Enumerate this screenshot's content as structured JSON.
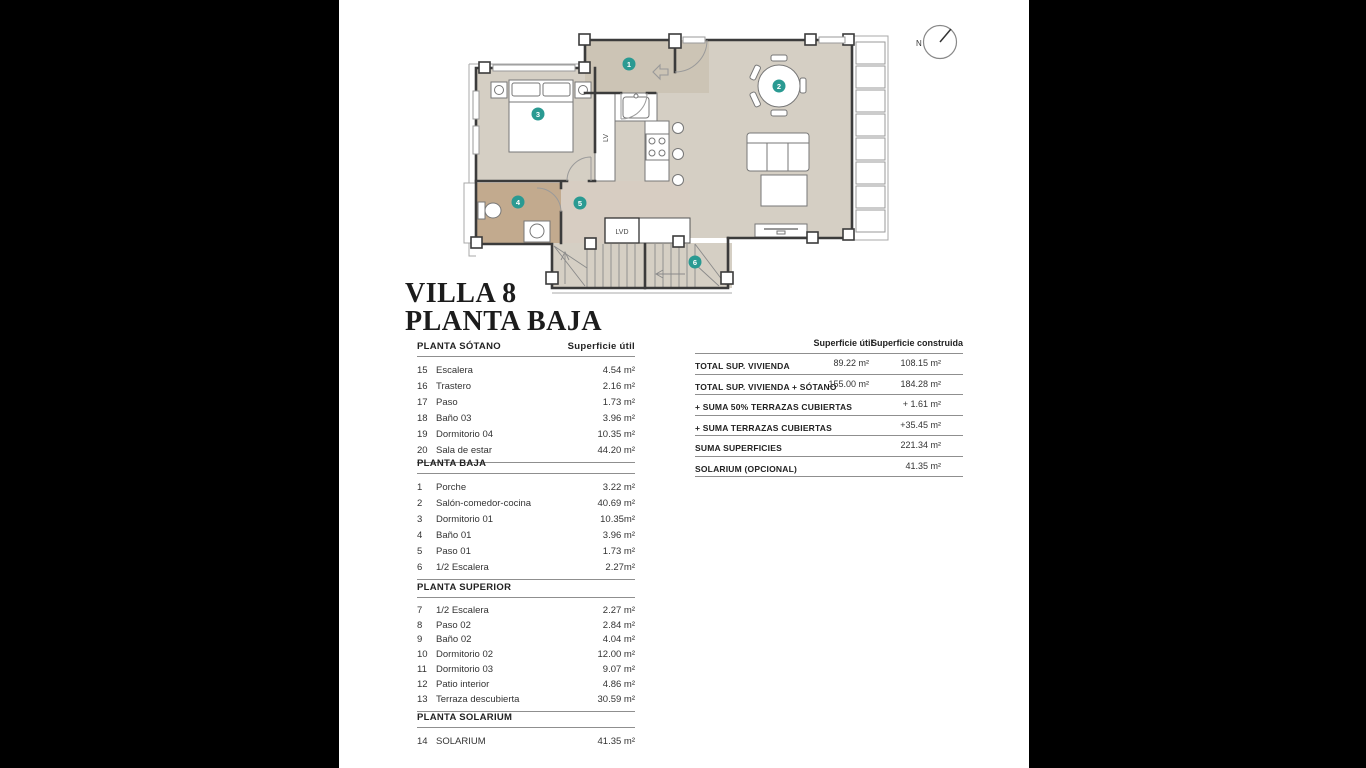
{
  "title": {
    "line1": "VILLA 8",
    "line2": "PLANTA BAJA"
  },
  "compass": {
    "label": "N"
  },
  "plan": {
    "labels": {
      "lv": "LV",
      "lvd": "LVD"
    },
    "markers": [
      "1",
      "2",
      "3",
      "4",
      "5",
      "6"
    ],
    "colors": {
      "floor": "#d5cfc4",
      "porch": "#ccc4b5",
      "hall": "#d7cdc2",
      "bath": "#c2aa8e",
      "marker": "#2a9a92",
      "wall": "#3b3b3b"
    }
  },
  "left_tables": [
    {
      "heading": "PLANTA SÓTANO",
      "value_header": "Superficie útil",
      "rows": [
        [
          "15",
          "Escalera",
          "4.54 m²"
        ],
        [
          "16",
          "Trastero",
          "2.16 m²"
        ],
        [
          "17",
          "Paso",
          "1.73 m²"
        ],
        [
          "18",
          "Baño 03",
          "3.96 m²"
        ],
        [
          "19",
          "Dormitorio 04",
          "10.35 m²"
        ],
        [
          "20",
          "Sala de estar",
          "44.20 m²"
        ]
      ]
    },
    {
      "heading": "PLANTA BAJA",
      "value_header": "",
      "rows": [
        [
          "1",
          "Porche",
          "3.22 m²"
        ],
        [
          "2",
          "Salón-comedor-cocina",
          "40.69 m²"
        ],
        [
          "3",
          "Dormitorio 01",
          "10.35m²"
        ],
        [
          "4",
          "Baño 01",
          "3.96 m²"
        ],
        [
          "5",
          "Paso 01",
          "1.73 m²"
        ],
        [
          "6",
          "1/2 Escalera",
          "2.27m²"
        ]
      ]
    },
    {
      "heading": "PLANTA SUPERIOR",
      "value_header": "",
      "rows": [
        [
          "7",
          "1/2 Escalera",
          "2.27 m²"
        ],
        [
          "8",
          "Paso 02",
          "2.84 m²"
        ],
        [
          "9",
          "Baño 02",
          "4.04 m²"
        ],
        [
          "10",
          "Dormitorio 02",
          "12.00 m²"
        ],
        [
          "11",
          "Dormitorio 03",
          "9.07 m²"
        ],
        [
          "12",
          "Patio interior",
          "4.86 m²"
        ],
        [
          "13",
          "Terraza descubierta",
          "30.59 m²"
        ]
      ]
    },
    {
      "heading": "PLANTA SOLARIUM",
      "value_header": "",
      "rows": [
        [
          "14",
          "SOLARIUM",
          "41.35 m²"
        ]
      ]
    }
  ],
  "summary_table": {
    "col1_header": "Superficie útil",
    "col2_header": "Superficie construida",
    "rows": [
      {
        "label": "TOTAL SUP. VIVIENDA",
        "util": "89.22 m²",
        "construida": "108.15 m²"
      },
      {
        "label": "TOTAL SUP. VIVIENDA + SÓTANO",
        "util": "155.00 m²",
        "construida": "184.28 m²"
      },
      {
        "label": "+ SUMA 50% TERRAZAS CUBIERTAS",
        "util": "",
        "construida": "+ 1.61 m²"
      },
      {
        "label": "+ SUMA TERRAZAS CUBIERTAS",
        "util": "",
        "construida": "+35.45 m²"
      },
      {
        "label": "SUMA SUPERFICIES",
        "util": "",
        "construida": "221.34 m²"
      },
      {
        "label": "SOLARIUM (OPCIONAL)",
        "util": "",
        "construida": "41.35 m²"
      }
    ]
  }
}
